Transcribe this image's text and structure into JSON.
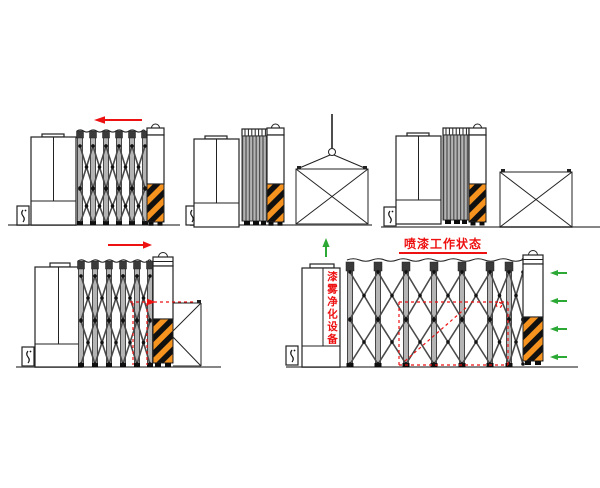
{
  "diagram": {
    "title": "喷漆工作状态",
    "purifier_label": "漆雾净化设备"
  },
  "colors": {
    "line": "#222222",
    "red": "#ee1111",
    "green": "#2ca835",
    "orange": "#f6921e",
    "dark": "#101010",
    "gray": "#b4b4b4",
    "link": "#4a4a4a",
    "ground": "#757575"
  },
  "icons": {
    "red_arrow_left": "retract-direction-arrow",
    "red_arrow_right": "extend-direction-arrow",
    "green_arrow_up": "exhaust-up-arrow",
    "green_arrow_left": "airflow-in-arrow",
    "crane_hook": "lifting-hook",
    "hazard_stripes": "warning-stripe-post",
    "control_box": "control-unit"
  }
}
